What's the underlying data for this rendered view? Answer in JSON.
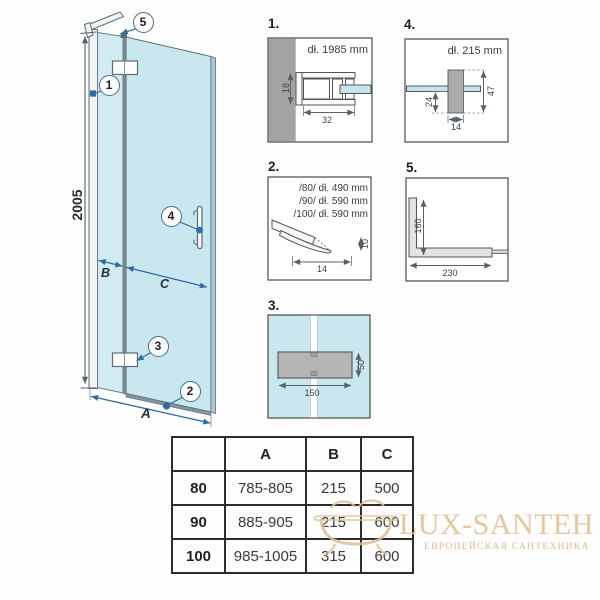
{
  "main_diagram": {
    "height_dim": "2005",
    "width_dim_label": "A",
    "fixed_panel_dim_label": "B",
    "door_dim_label": "C",
    "callouts": {
      "wall_profile": "1",
      "bottom_seal": "2",
      "hinge": "3",
      "handle": "4",
      "support_bar": "5"
    }
  },
  "detail_panels": {
    "panel_1": {
      "label": "1.",
      "length_note": "dł. 1985 mm",
      "dim_height": "18",
      "dim_width": "32"
    },
    "panel_2": {
      "label": "2.",
      "length_notes": [
        "/80/ dł. 490 mm",
        "/90/ dł. 590 mm",
        "/100/ dł. 590 mm"
      ],
      "dim_height": "10",
      "dim_width": "14"
    },
    "panel_3": {
      "label": "3.",
      "dim_width": "150",
      "dim_height": "50"
    },
    "panel_4": {
      "label": "4.",
      "length_note": "dł. 215 mm",
      "dim_offset": "24",
      "dim_height": "47",
      "dim_width": "14"
    },
    "panel_5": {
      "label": "5.",
      "dim_height": "160",
      "dim_width": "230"
    }
  },
  "size_table": {
    "columns": [
      "",
      "A",
      "B",
      "C"
    ],
    "rows": [
      {
        "size": "80",
        "a": "785-805",
        "b": "215",
        "c": "500"
      },
      {
        "size": "90",
        "a": "885-905",
        "b": "215",
        "c": "600"
      },
      {
        "size": "100",
        "a": "985-1005",
        "b": "315",
        "c": "600"
      }
    ]
  },
  "watermark": {
    "brand": "LUX-SANTEH",
    "tagline": "ЕВРОПЕЙСКАЯ САНТЕХНИКА"
  },
  "colors": {
    "glass": "#cdeaf0",
    "dim_blue": "#2e6da4",
    "wall_gray": "#a3a3a3",
    "watermark_gold": "#e2c79e"
  }
}
